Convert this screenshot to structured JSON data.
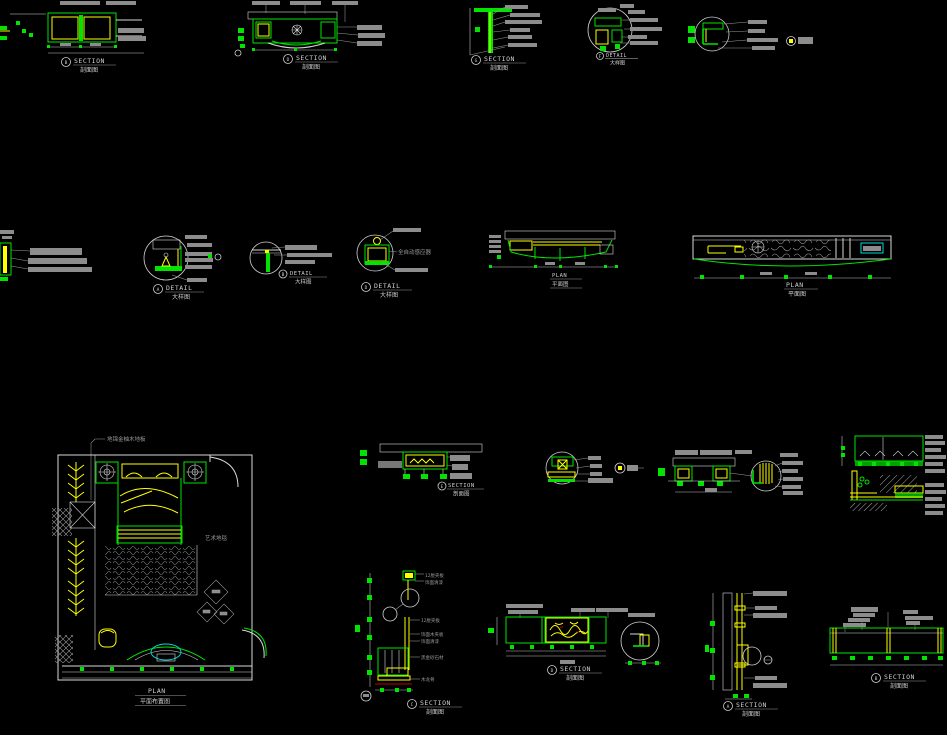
{
  "canvas": {
    "background": "#000000"
  },
  "colors": {
    "line_green": "#00e400",
    "line_yellow": "#ffff00",
    "line_white": "#d9d9d9",
    "annotation_gray": "#8c8c8c",
    "accent_cyan": "#00d8d8",
    "accent_red": "#c40000"
  },
  "titles": {
    "top1": {
      "letter": "B",
      "en": "SECTION",
      "cn": "剖面图"
    },
    "top2": {
      "letter": "D",
      "en": "SECTION",
      "cn": "剖面图"
    },
    "top3": {
      "letter": "G",
      "en": "SECTION",
      "cn": "剖面图"
    },
    "top4": {
      "letter": "F",
      "en": "DETAIL",
      "cn": "大样图"
    },
    "mid1": {
      "letter": "A",
      "en": "DETAIL",
      "cn": "大样图"
    },
    "mid2": {
      "letter": "B",
      "en": "DETAIL",
      "cn": "大样图"
    },
    "mid3": {
      "letter": "D",
      "en": "DETAIL",
      "cn": "大样图"
    },
    "mid4": {
      "en": "PLAN",
      "cn": "平面图"
    },
    "mid5": {
      "en": "PLAN",
      "cn": "平面图"
    },
    "plan": {
      "en": "PLAN",
      "cn": "平面布置图"
    },
    "row3a": {
      "letter": "E",
      "en": "SECTION",
      "cn": "剖面图"
    },
    "bot1": {
      "letter": "C",
      "en": "SECTION",
      "cn": "剖面图"
    },
    "bot2": {
      "letter": "D",
      "en": "SECTION",
      "cn": "剖面图"
    },
    "bot3": {
      "letter": "A",
      "en": "SECTION",
      "cn": "剖面图"
    },
    "bot4": {
      "letter": "B",
      "en": "SECTION",
      "cn": "剖面图"
    }
  },
  "notes": {
    "floor": "地锦金柚木地板",
    "carpet": "艺术地毯",
    "sensor": "全自动感应器",
    "plywood": "12厘夹板",
    "veneer": "饰面木夹板",
    "lacquer": "饰面清漆",
    "stone": "黑金砂石材",
    "batten": "木龙骨"
  }
}
